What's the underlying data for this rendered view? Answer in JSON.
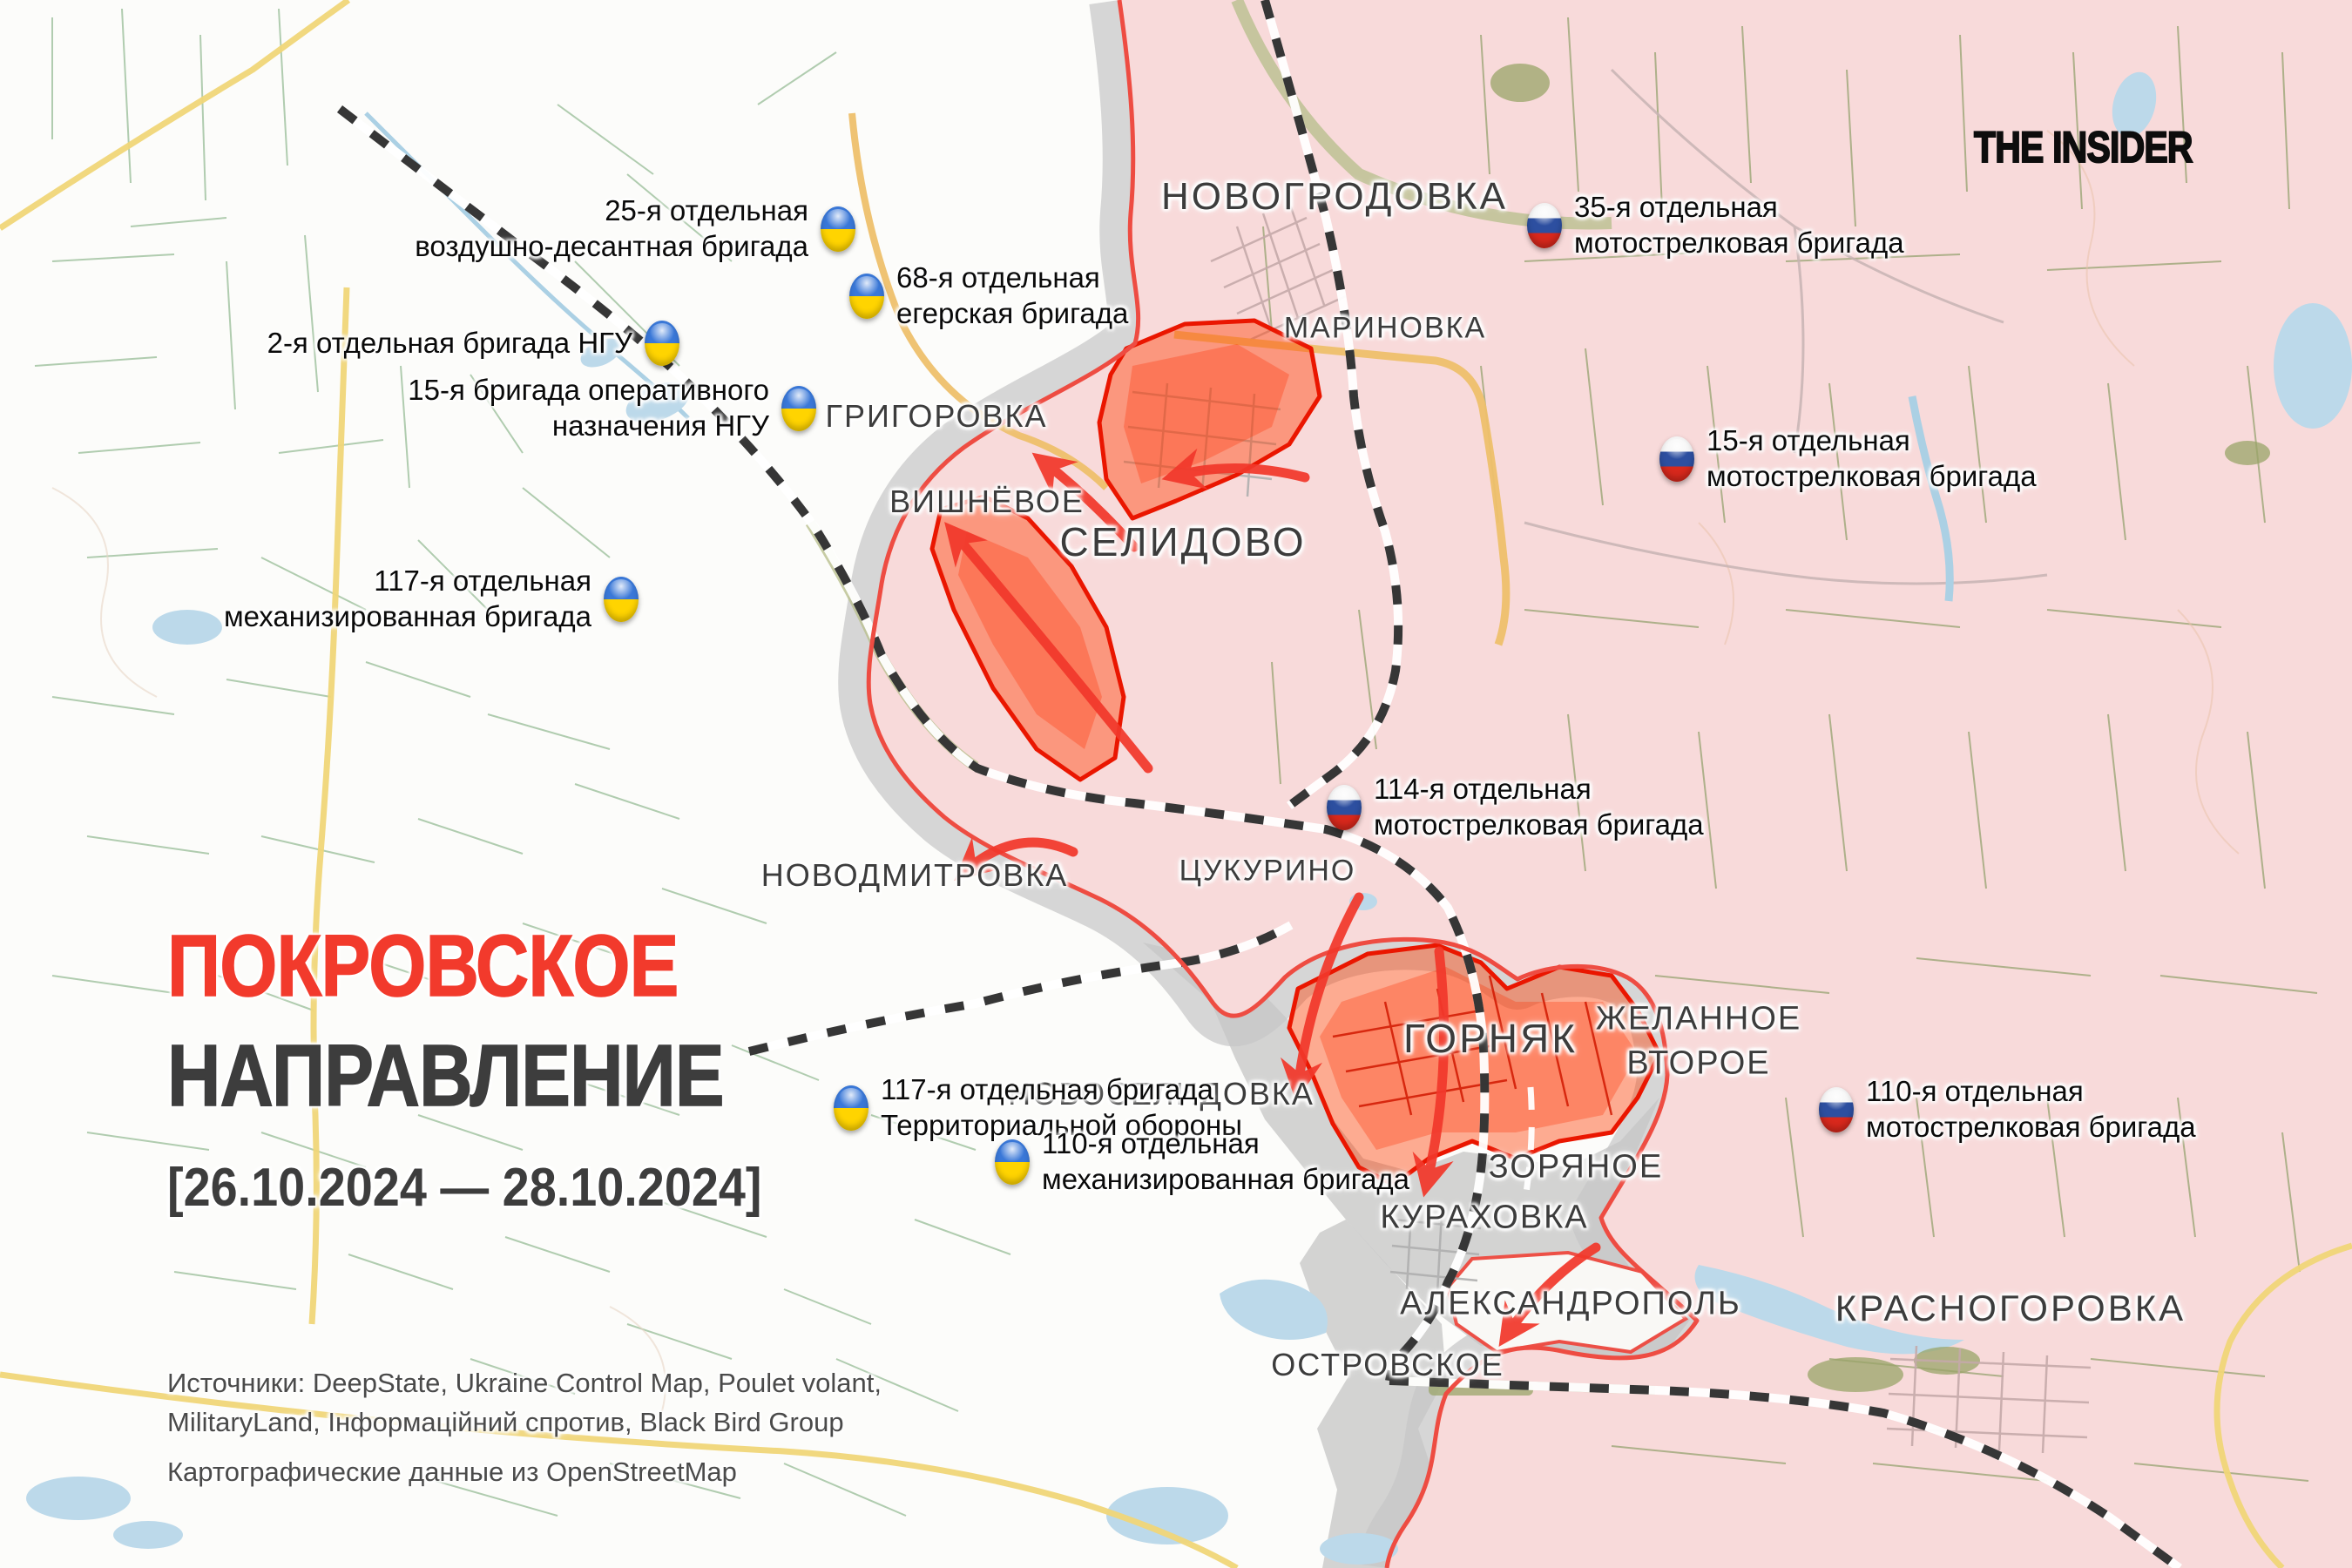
{
  "branding": {
    "logo_text": "THE INSIDER"
  },
  "title": {
    "region": "ПОКРОВСКОЕ",
    "direction": "НАПРАВЛЕНИЕ",
    "date_range": "[26.10.2024 — 28.10.2024]"
  },
  "sources": {
    "line1": "Источники: DeepState, Ukraine Control Map, Poulet volant,",
    "line2": "MilitaryLand, Інформаційний спротив, Black Bird Group",
    "line3": "Картографические данные из OpenStreetMap"
  },
  "towns": {
    "novogrodovka": "НОВОГРОДОВКА",
    "marinovka": "МАРИНОВКА",
    "grigorovka": "ГРИГОРОВКА",
    "vishnyovoe": "ВИШНЁВОЕ",
    "selidovo": "СЕЛИДОВО",
    "novodmitrovka": "НОВОДМИТРОВКА",
    "tsukurino": "ЦУКУРИНО",
    "novoselidovka": "НОВОСЕЛИДОВКА",
    "gornyak": "ГОРНЯК",
    "zhelannoe_line1": "ЖЕЛАННОЕ",
    "zhelannoe_line2": "ВТОРОЕ",
    "zoryanoe": "ЗОРЯНОЕ",
    "kurakhovka": "КУРАХОВКА",
    "aleksandropol": "АЛЕКСАНДРОПОЛЬ",
    "ostrovskoe": "ОСТРОВСКОЕ",
    "krasnogorovka": "КРАСНОГОРОВКА"
  },
  "brigades_ua": [
    {
      "line1": "25-я отдельная",
      "line2": "воздушно-десантная бригада"
    },
    {
      "line1": "68-я отдельная",
      "line2": "егерская бригада"
    },
    {
      "line1": "2-я отдельная бригада НГУ",
      "line2": ""
    },
    {
      "line1": "15-я бригада оперативного",
      "line2": "назначения НГУ"
    },
    {
      "line1": "117-я отдельная",
      "line2": "механизированная бригада"
    },
    {
      "line1": "117-я отдельная бригада",
      "line2": "Территориальной обороны"
    },
    {
      "line1": "110-я отдельная",
      "line2": "механизированная бригада"
    }
  ],
  "brigades_ru": [
    {
      "line1": "35-я отдельная",
      "line2": "мотострелковая бригада"
    },
    {
      "line1": "15-я отдельная",
      "line2": "мотострелковая бригада"
    },
    {
      "line1": "114-я отдельная",
      "line2": "мотострелковая бригада"
    },
    {
      "line1": "110-я отдельная",
      "line2": "мотострелковая бригада"
    }
  ],
  "map_colors": {
    "occupied_area": "#f8dada",
    "contested_area": "#c7c7c7",
    "assault_area": "#ff3c00",
    "front_line": "#ee4c42",
    "attack_arrow": "#f2382b",
    "title_accent": "#f23a2c",
    "title_dark": "#3d3d3d",
    "ukraine_flag_blue": "#3a78d8",
    "ukraine_flag_yellow": "#ffd400",
    "russia_flag_white": "#f5f5f5",
    "russia_flag_blue": "#2d4fa0",
    "russia_flag_red": "#d8281c"
  }
}
